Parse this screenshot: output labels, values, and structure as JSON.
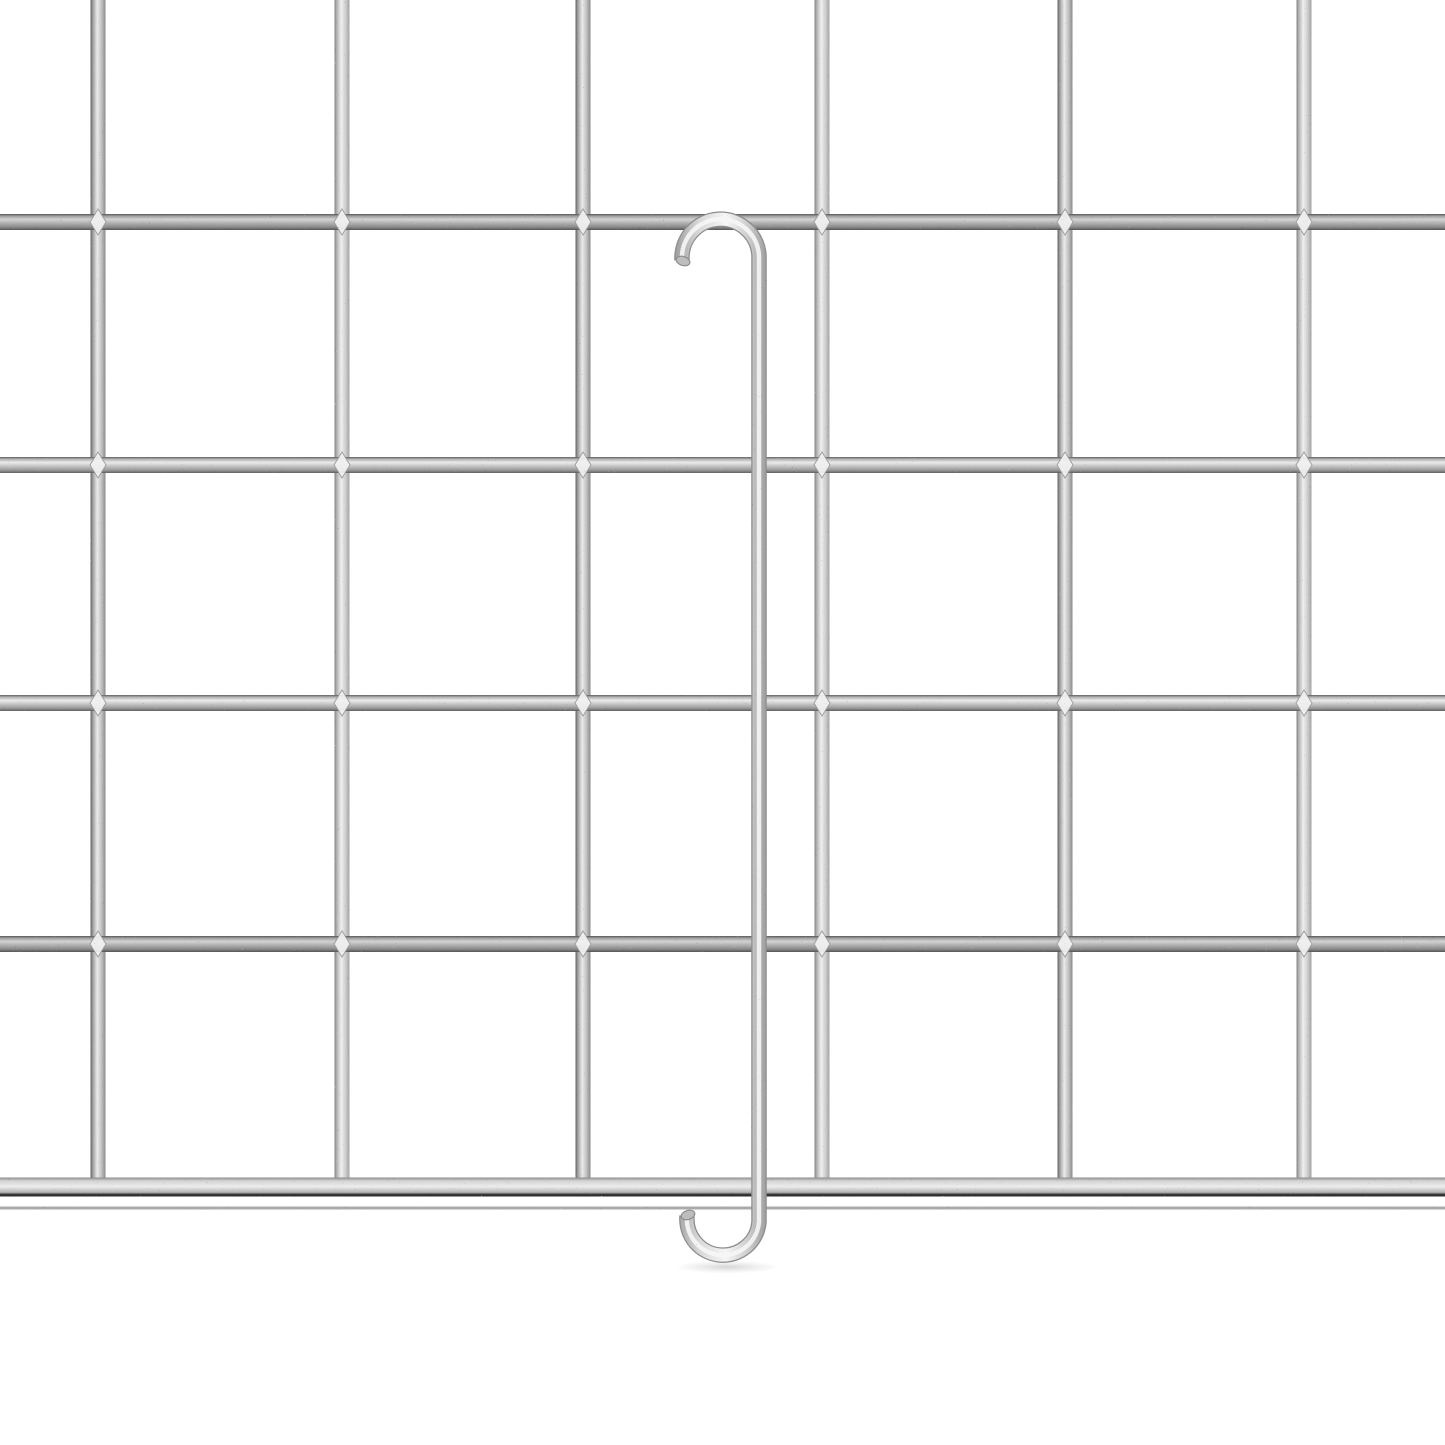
{
  "scene": {
    "description": "Product photo: galvanized wire mesh grid panel with a long double-ended metal hanging hook (J-hook) hooked over the top wire and curving under the bottom rail",
    "background_color": "#ffffff",
    "canvas": {
      "width": 1445,
      "height": 1445
    }
  },
  "palette": {
    "wire_edge_dark": "#606060",
    "wire_mid": "#b5b5b5",
    "wire_light": "#ebebeb",
    "rail_bottom_edge": "#2e2e2e",
    "back_wire_color": "#9b9b9b",
    "weld_joint_fill": "#f1f1f1",
    "weld_joint_edge": "#9e9e9e",
    "taper_fill": "#787878",
    "hook_edge": "#8d8d8d",
    "hook_mid": "#c9c9c9",
    "hook_highlight": "#f6f6f6",
    "speckle_dark": "#3a3a3a",
    "speckle_light": "#ffffff",
    "shadow_color": "#000000"
  },
  "grid": {
    "vertical_wires": [
      {
        "x": 98,
        "tone": "medium"
      },
      {
        "x": 342,
        "tone": "light"
      },
      {
        "x": 583,
        "tone": "medium"
      },
      {
        "x": 822,
        "tone": "light"
      },
      {
        "x": 1065,
        "tone": "medium"
      },
      {
        "x": 1304,
        "tone": "light"
      }
    ],
    "horizontal_wires": [
      {
        "y": 222,
        "tone": "dark"
      },
      {
        "y": 465,
        "tone": "medium"
      },
      {
        "y": 703,
        "tone": "medium"
      },
      {
        "y": 944,
        "tone": "dark"
      }
    ],
    "vertical_wire_width": 15,
    "horizontal_wire_height": 16,
    "vertical_wire_top": 0,
    "vertical_wire_bottom": 1179,
    "bottom_rail": {
      "y_center": 1187,
      "height": 19
    },
    "back_wire": {
      "y_center": 1208,
      "height": 3
    },
    "taper_tip_bottom": 1197
  },
  "hook": {
    "rod_x": 759,
    "stroke_width": 14,
    "top_arc": {
      "cx": 720.5,
      "cy": 256,
      "r": 38.5,
      "tip_x": 682,
      "tip_y": 260
    },
    "bottom_arc": {
      "cx": 723,
      "cy": 1222,
      "r": 36,
      "tip_x": 687,
      "tip_y": 1216
    },
    "gradient_span": {
      "x1": 668,
      "x2": 773
    }
  },
  "shadow": {
    "cx": 727,
    "cy": 1267,
    "rx": 52,
    "ry": 6.5,
    "opacity": 0.35
  }
}
